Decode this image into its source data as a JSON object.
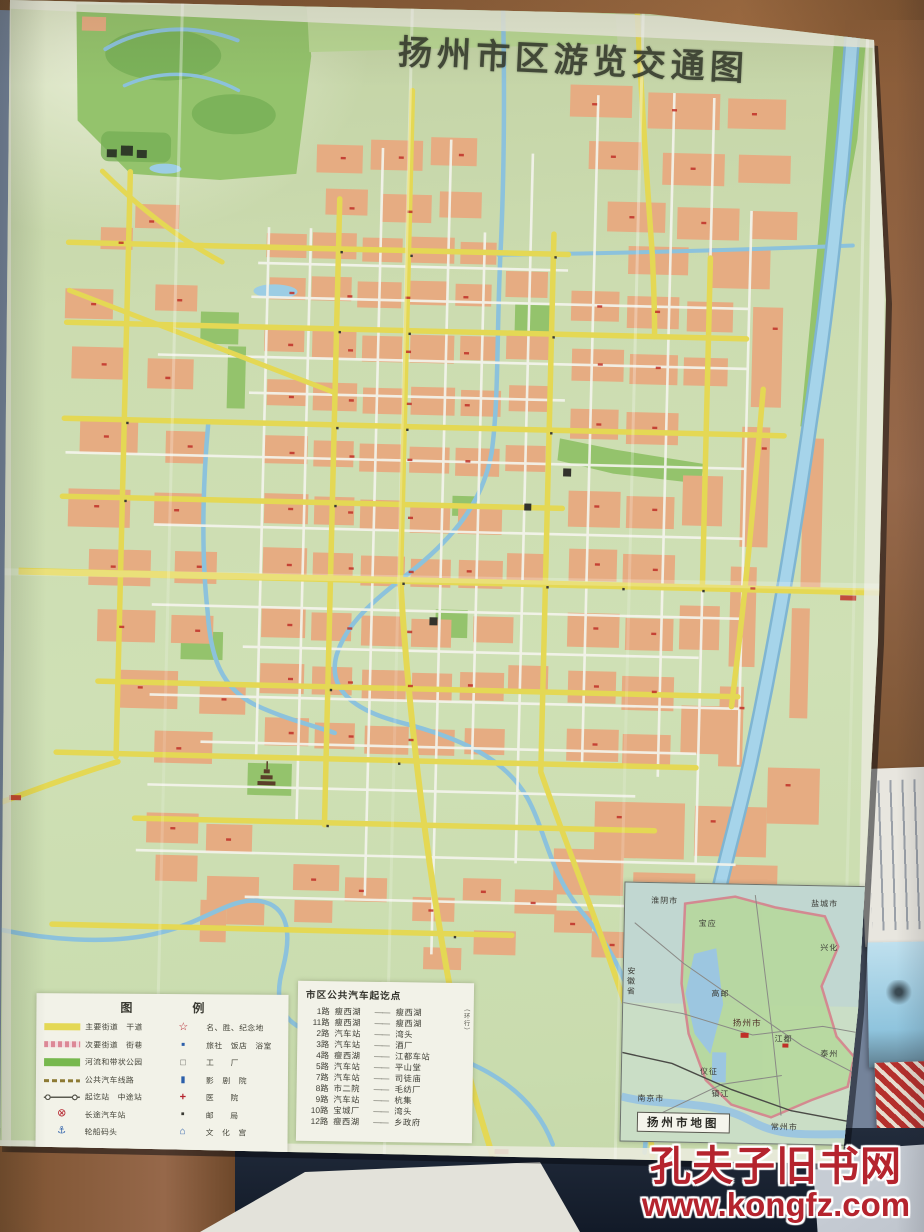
{
  "map": {
    "title": "扬州市区游览交通图",
    "colors": {
      "paper": "#cfe0b5",
      "urban_block": "#e6ac82",
      "main_road": "#e4d854",
      "water": "#8cc2dc",
      "park": "#94c36c",
      "label_red": "#c03028"
    },
    "legend": {
      "title": "图　　例",
      "left": [
        {
          "icon": "major-road-swatch",
          "label": "主要街道　干道"
        },
        {
          "icon": "minor-road-swatch",
          "label": "次要街道　街巷"
        },
        {
          "icon": "park-band-swatch",
          "label": "河流和带状公园"
        },
        {
          "icon": "bus-line-swatch",
          "label": "公共汽车线路"
        },
        {
          "icon": "stops-swatch",
          "label": "起讫站　中途站"
        },
        {
          "icon": "coach-station-symbol",
          "label": "长途汽车站"
        },
        {
          "icon": "wharf-symbol",
          "label": "轮船码头"
        }
      ],
      "right": [
        {
          "icon": "star-symbol",
          "label": "名、胜、纪念地"
        },
        {
          "icon": "hotel-symbol",
          "label": "旅社　饭店　浴室"
        },
        {
          "icon": "factory-symbol",
          "label": "工　　厂"
        },
        {
          "icon": "theater-symbol",
          "label": "影　剧　院"
        },
        {
          "icon": "hospital-symbol",
          "label": "医　　院"
        },
        {
          "icon": "post-symbol",
          "label": "邮　　局"
        },
        {
          "icon": "culture-symbol",
          "label": "文　化　宫"
        }
      ]
    },
    "bus_routes": {
      "title": "市区公共汽车起讫点",
      "separator": "——",
      "loop_note": "（环行）",
      "routes": [
        {
          "no": "1路",
          "from": "瘦西湖",
          "to": "瘦西湖"
        },
        {
          "no": "11路",
          "from": "瘦西湖",
          "to": "瘦西湖"
        },
        {
          "no": "2路",
          "from": "汽车站",
          "to": "湾头"
        },
        {
          "no": "3路",
          "from": "汽车站",
          "to": "酒厂"
        },
        {
          "no": "4路",
          "from": "瘦西湖",
          "to": "江都车站"
        },
        {
          "no": "5路",
          "from": "汽车站",
          "to": "平山堂"
        },
        {
          "no": "7路",
          "from": "汽车站",
          "to": "司徒庙"
        },
        {
          "no": "8路",
          "from": "市二院",
          "to": "毛纺厂"
        },
        {
          "no": "9路",
          "from": "汽车站",
          "to": "杭集"
        },
        {
          "no": "10路",
          "from": "宝城厂",
          "to": "湾头"
        },
        {
          "no": "12路",
          "from": "瘦西湖",
          "to": "乡政府"
        }
      ]
    },
    "inset": {
      "caption": "扬州市地图",
      "labels": [
        "淮阴市",
        "盐城市",
        "宝应",
        "兴化",
        "高邮",
        "安徽省",
        "扬州市",
        "江都",
        "泰州",
        "仪征",
        "南京市",
        "镇江",
        "常州市"
      ]
    }
  },
  "watermark": {
    "site_name": "孔夫子旧书网",
    "site_url": "www.kongfz.com",
    "color": "#b5242e"
  }
}
